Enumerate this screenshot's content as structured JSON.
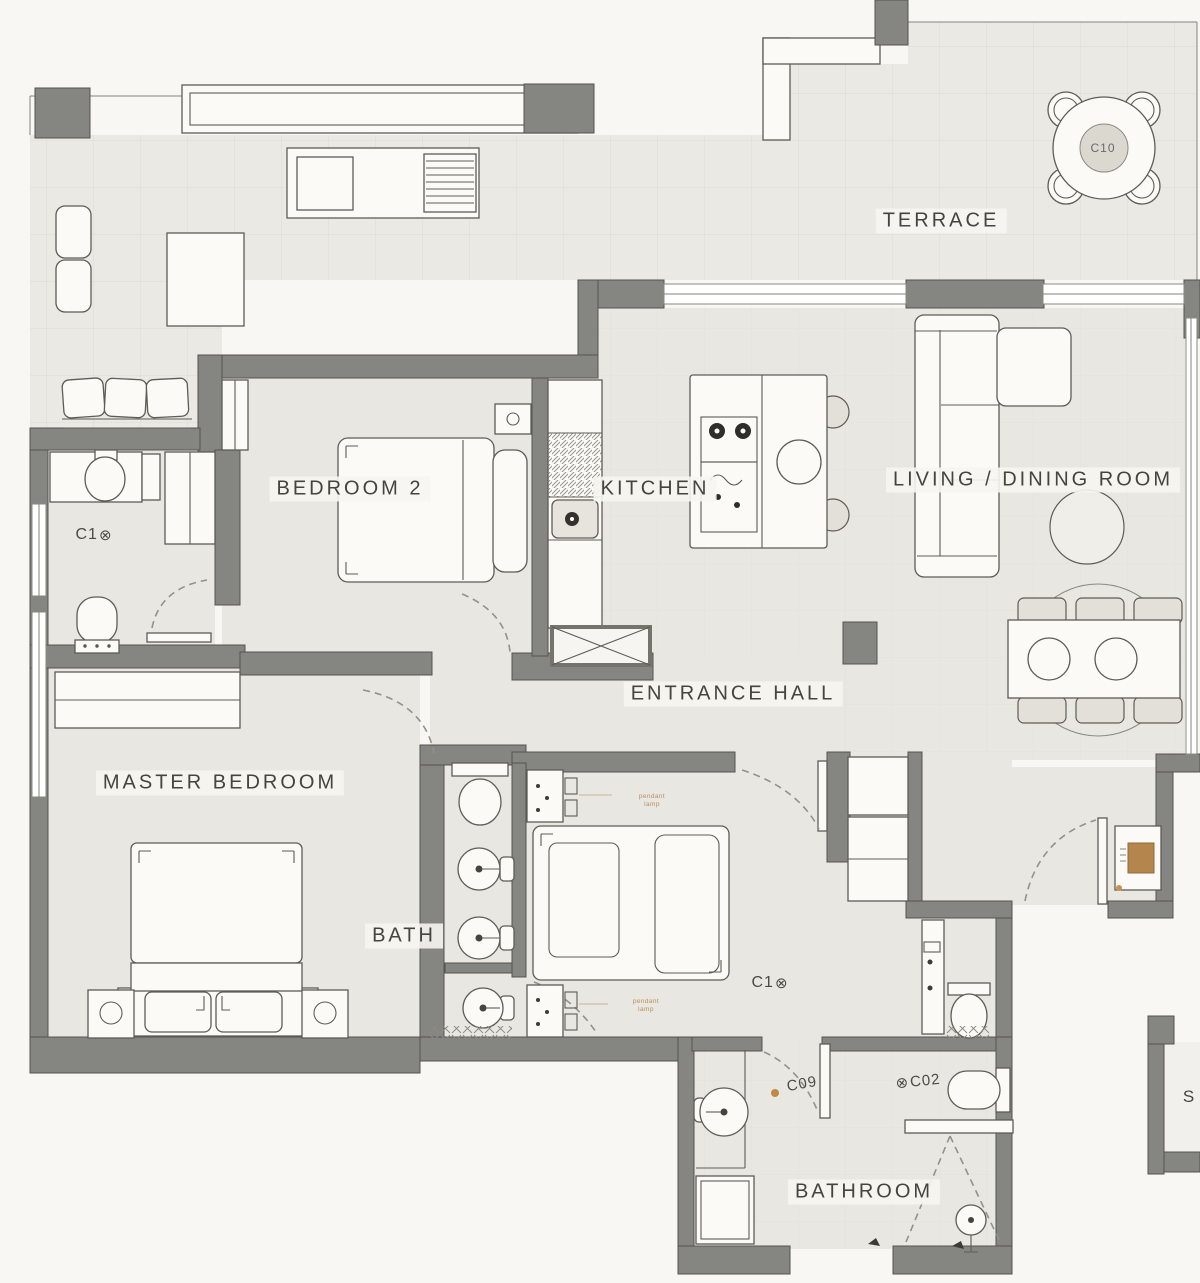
{
  "palette": {
    "wall_gray": "#858581",
    "floor": "#e9e7e1",
    "terrace_floor": "#ebe9e3",
    "background": "#f8f7f4",
    "furniture_fill": "#fbfaf7",
    "accent_wood": "#b5854e",
    "annotation_orange": "#c18f5a",
    "text": "#45443f"
  },
  "icons": {
    "circle_x": "⊗"
  },
  "rooms": {
    "terrace": {
      "label": "TERRACE"
    },
    "bedroom2": {
      "label": "BEDROOM 2"
    },
    "kitchen": {
      "label": "KITCHEN"
    },
    "living_dining": {
      "label": "LIVING / DINING ROOM"
    },
    "entrance_hall": {
      "label": "ENTRANCE HALL"
    },
    "master_bedroom": {
      "label": "MASTER BEDROOM"
    },
    "bath": {
      "label": "BATH"
    },
    "bathroom": {
      "label": "BATHROOM"
    },
    "partial_room": {
      "label": "S"
    }
  },
  "codes": {
    "terrace_table": "C10",
    "upper_wc": "C1",
    "middle_bedroom": "C1",
    "bathroom_door": "C09",
    "bathroom_shower": "C02"
  },
  "annotations": {
    "pendant_lamp_upper": "pendant lamp",
    "pendant_lamp_lower": "pendant lamp"
  }
}
